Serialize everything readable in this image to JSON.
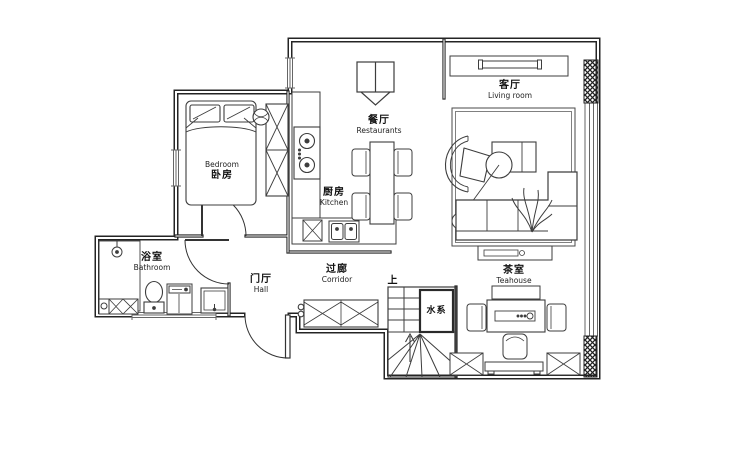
{
  "title": "apartment-floor-plan",
  "rooms": {
    "bedroom": {
      "en": "Bedroom",
      "zh": "卧房"
    },
    "kitchen": {
      "zh": "厨房",
      "en": "Kitchen"
    },
    "dining": {
      "zh": "餐厅",
      "en": "Restaurants"
    },
    "living": {
      "zh": "客厅",
      "en": "Living room"
    },
    "bathroom": {
      "zh": "浴室",
      "en": "Bathroom"
    },
    "hall": {
      "zh": "门厅",
      "en": "Hall"
    },
    "corridor": {
      "zh": "过廊",
      "en": "Corridor"
    },
    "teahouse": {
      "zh": "茶室",
      "en": "Teahouse"
    },
    "stairs_up": {
      "zh": "上"
    },
    "water": {
      "zh": "水系"
    }
  },
  "colors": {
    "wall": "#242424",
    "furniture": "#3d3d3d",
    "window": "#666666",
    "background": "#ffffff"
  }
}
